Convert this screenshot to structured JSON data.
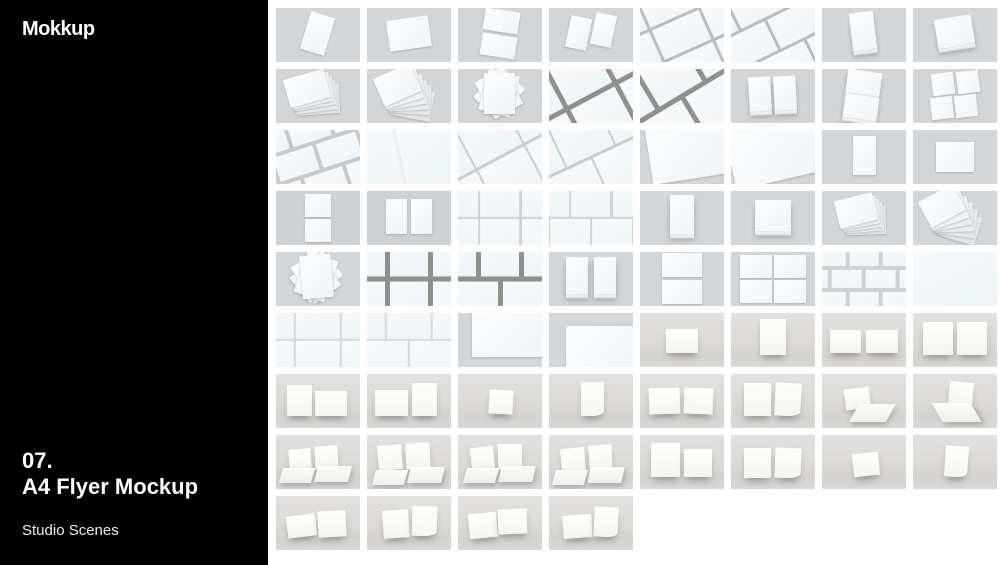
{
  "sidebar": {
    "logo": "Mokkup",
    "number": "07.",
    "title": "A4 Flyer Mockup",
    "subtitle": "Studio Scenes"
  },
  "colors": {
    "sidebar_bg": "#000000",
    "page_bg": "#ffffff",
    "thumb_bg": "#d3d6d8",
    "thumb_bg_dark": "#ced2d5",
    "wall_bg": "#dddcda",
    "paper": "#f8fbfd",
    "grid_line_light": "#c9cdcf",
    "grid_line_dark": "#8e928e",
    "text": "#ffffff"
  },
  "gallery": {
    "thumbnails": [
      {
        "scene": "single-portrait-tilted"
      },
      {
        "scene": "single-landscape-tilted"
      },
      {
        "scene": "two-sheets-stacked-tilted"
      },
      {
        "scene": "two-sheets-side-tilted"
      },
      {
        "scene": "diagonal-grid"
      },
      {
        "scene": "diagonal-brick-grid"
      },
      {
        "scene": "portrait-stack-tilted"
      },
      {
        "scene": "landscape-stack-tilted"
      },
      {
        "scene": "fanned-stack"
      },
      {
        "scene": "fanned-stack-spread"
      },
      {
        "scene": "rotated-pile"
      },
      {
        "scene": "diagonal-grid-dark"
      },
      {
        "scene": "diagonal-brick-grid-dark"
      },
      {
        "scene": "two-stacks-side"
      },
      {
        "scene": "two-stacks-stacked-tilted"
      },
      {
        "scene": "four-grid-tilted"
      },
      {
        "scene": "tilted-brick-grid-loose"
      },
      {
        "scene": "flat-scatter"
      },
      {
        "scene": "diagonal-grid-light"
      },
      {
        "scene": "diagonal-brick-grid-light"
      },
      {
        "scene": "sheet-corner-tilted"
      },
      {
        "scene": "sheet-corner-tilted-alt"
      },
      {
        "scene": "single-portrait-flat"
      },
      {
        "scene": "single-landscape-flat"
      },
      {
        "scene": "two-sheets-stacked-flat"
      },
      {
        "scene": "two-sheets-side-flat"
      },
      {
        "scene": "straight-grid-light"
      },
      {
        "scene": "straight-brick-grid-light"
      },
      {
        "scene": "portrait-stack-flat"
      },
      {
        "scene": "landscape-stack-flat"
      },
      {
        "scene": "fanned-stack-tilted"
      },
      {
        "scene": "fanned-stack-messy"
      },
      {
        "scene": "rotated-pile-flat"
      },
      {
        "scene": "straight-grid-dark"
      },
      {
        "scene": "straight-brick-grid-dark"
      },
      {
        "scene": "two-stacks-side-shadow"
      },
      {
        "scene": "two-sheets-stacked-large"
      },
      {
        "scene": "four-grid-flat"
      },
      {
        "scene": "brick-rows-flat"
      },
      {
        "scene": "flat-scatter-light"
      },
      {
        "scene": "straight-grid-thin"
      },
      {
        "scene": "straight-brick-grid-thin"
      },
      {
        "scene": "sheet-corner-flat"
      },
      {
        "scene": "sheet-corner-flat-alt"
      },
      {
        "scene": "leaning-sheet-wide"
      },
      {
        "scene": "leaning-sheet-tall"
      },
      {
        "scene": "two-leaning-sheets-wide"
      },
      {
        "scene": "two-leaning-sheets-tall"
      },
      {
        "scene": "leaning-pair-mixed"
      },
      {
        "scene": "leaning-pair-mixed-alt"
      },
      {
        "scene": "leaning-sheet-small"
      },
      {
        "scene": "leaning-sheet-curled"
      },
      {
        "scene": "two-leaning-sheets"
      },
      {
        "scene": "two-leaning-sheets-curled"
      },
      {
        "scene": "leaning-and-flat-sheet"
      },
      {
        "scene": "leaning-and-flat-sheet-alt"
      },
      {
        "scene": "leaning-flat-perspective"
      },
      {
        "scene": "leaning-flat-perspective-2"
      },
      {
        "scene": "leaning-flat-perspective-3"
      },
      {
        "scene": "leaning-flat-perspective-4"
      },
      {
        "scene": "two-leaning-staggered"
      },
      {
        "scene": "two-leaning-curled-pair"
      },
      {
        "scene": "leaning-sheet-angled"
      },
      {
        "scene": "leaning-sheet-curled-angled"
      },
      {
        "scene": "two-leaning-angled"
      },
      {
        "scene": "two-leaning-angled-curled"
      },
      {
        "scene": "two-leaning-angled-staggered"
      },
      {
        "scene": "two-leaning-angled-mixed"
      }
    ]
  }
}
